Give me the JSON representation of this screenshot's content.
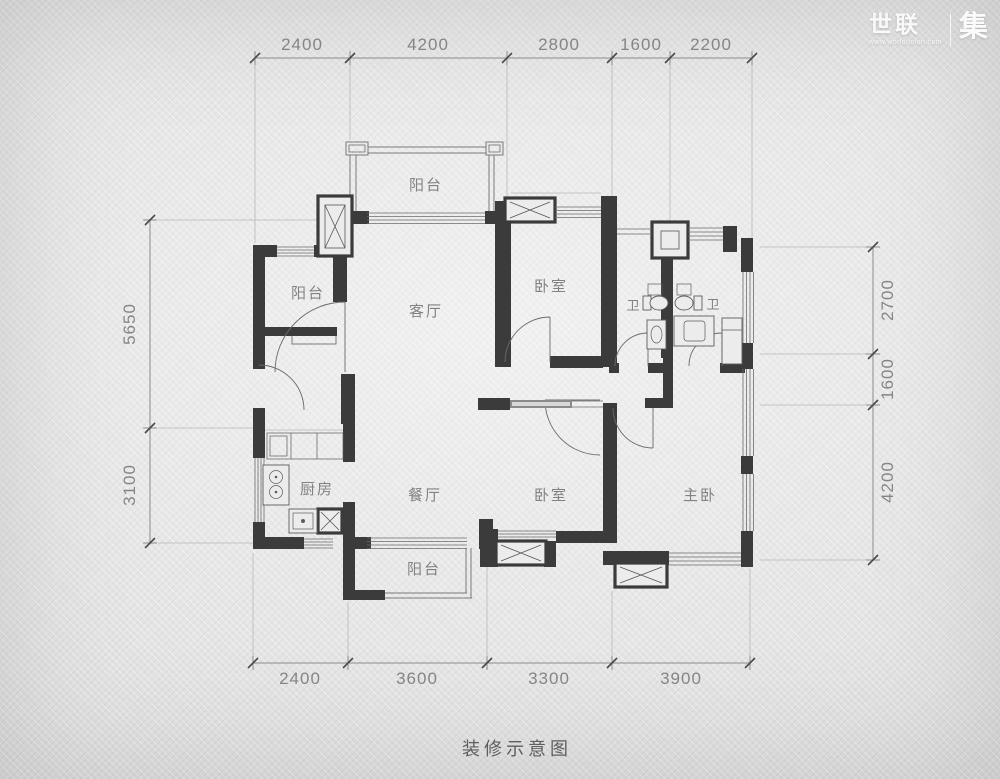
{
  "header": {
    "logo_primary": "世联",
    "logo_secondary": "集",
    "logo_url": "www.worldunion.com"
  },
  "title": "装修示意图",
  "dimensions": {
    "top": [
      "2400",
      "4200",
      "2800",
      "1600",
      "2200"
    ],
    "bottom": [
      "2400",
      "3600",
      "3300",
      "3900"
    ],
    "left": [
      "5650",
      "3100"
    ],
    "right": [
      "2700",
      "1600",
      "4200"
    ]
  },
  "rooms": {
    "balcony_top": "阳台",
    "balcony_left": "阳台",
    "balcony_bottom": "阳台",
    "living": "客厅",
    "dining": "餐厅",
    "kitchen": "厨房",
    "bedroom_top": "卧室",
    "bedroom_bottom": "卧室",
    "master": "主卧",
    "bath_left": "卫",
    "bath_right": "卫"
  },
  "colors": {
    "background": "#dfdfdf",
    "wall": "#3b3b3b",
    "dimension_text": "#858585",
    "room_text": "#828282",
    "title_text": "#5e5e5e",
    "logo_text": "#fdfdfd"
  }
}
